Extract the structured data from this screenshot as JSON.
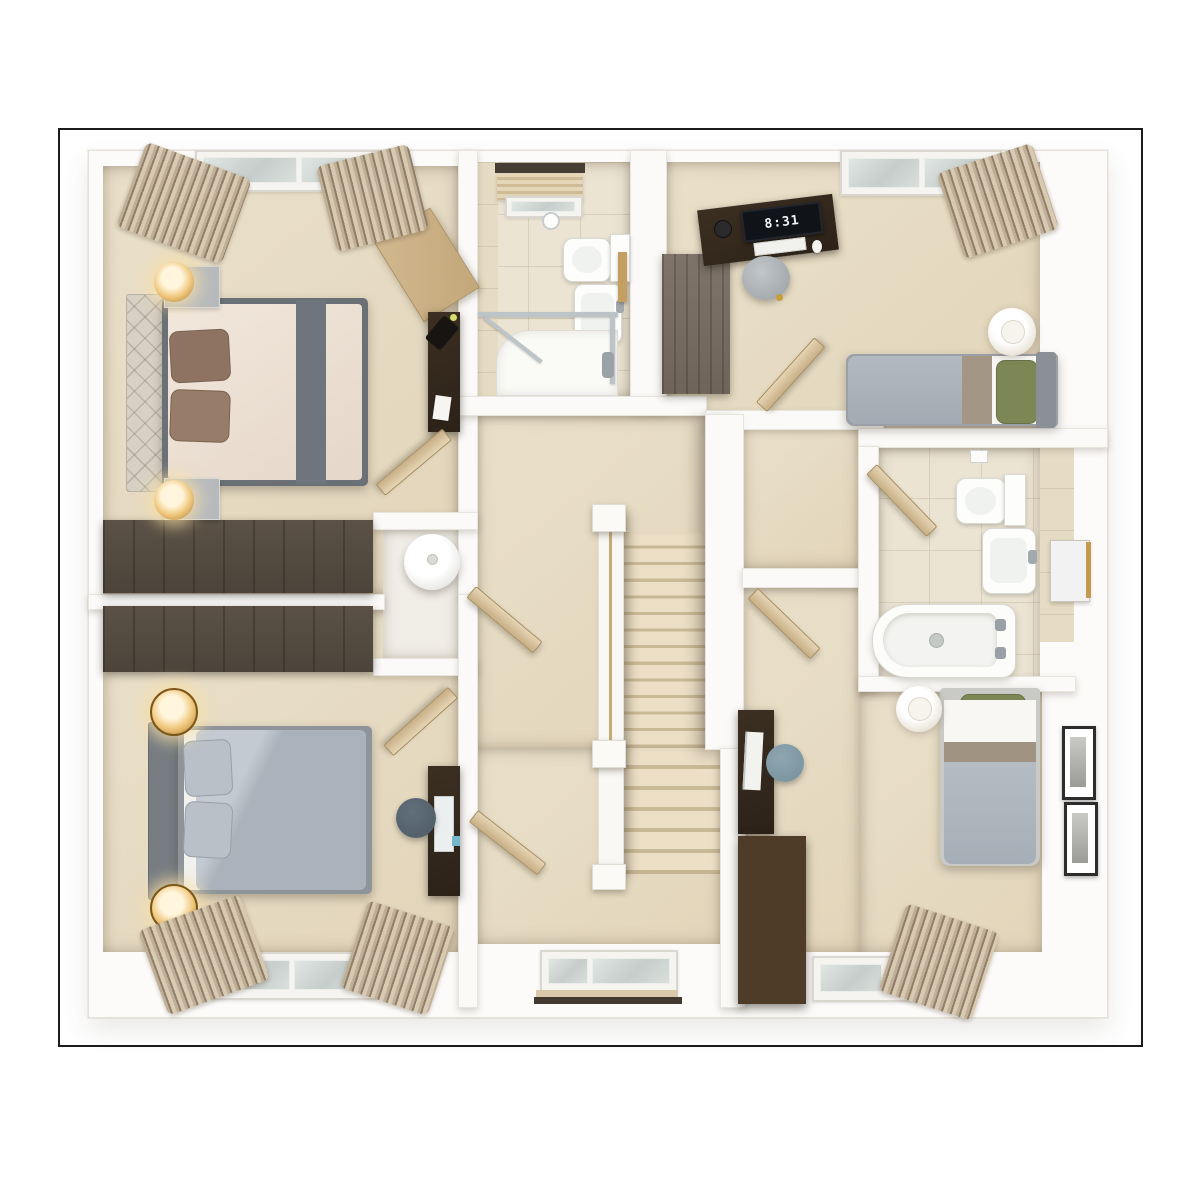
{
  "scene": {
    "type": "3d-top-down-floor-plan-render",
    "rooms": [
      {
        "name": "bedroom-top-left",
        "furniture": [
          "double-bed",
          "tufted-headboard",
          "brown-pillows",
          "grey-bed-runner",
          "two-nightstands",
          "two-amber-table-lamps",
          "corner-desk",
          "dark-side-cabinet",
          "desk-lamp",
          "built-in-wardrobe",
          "window-with-curtains",
          "open-door"
        ]
      },
      {
        "name": "ensuite-shower-room",
        "furniture": [
          "toilet",
          "cistern",
          "wash-basin",
          "shower-tray",
          "glass-shower-screen",
          "roller-blind-window",
          "wood-shelf",
          "towel-ring"
        ]
      },
      {
        "name": "bedroom-top-right",
        "furniture": [
          "single-bed",
          "green-pillow",
          "grey-duvet",
          "desk",
          "monitor-with-clock",
          "keyboard",
          "mouse",
          "alarm-clock",
          "round-pouf",
          "wardrobe",
          "white-table-lamp",
          "window-with-curtain",
          "open-door"
        ]
      },
      {
        "name": "family-bathroom",
        "furniture": [
          "toilet",
          "cistern",
          "wash-basin",
          "mirror-cabinet",
          "bathtub",
          "open-door"
        ]
      },
      {
        "name": "landing",
        "furniture": [
          "staircase-upper-flight",
          "staircase-lower-flight",
          "balustrade",
          "newel-posts",
          "airing-cupboard",
          "hot-water-cylinder",
          "hall-window",
          "open-doors"
        ]
      },
      {
        "name": "bedroom-bottom-left",
        "furniture": [
          "double-bed",
          "grey-duvet",
          "grey-pillows",
          "two-brass-table-lamps",
          "built-in-wardrobe",
          "desk",
          "round-stool",
          "window-with-curtains",
          "open-door"
        ]
      },
      {
        "name": "bedroom-bottom-right",
        "furniture": [
          "single-bed",
          "green-pillow",
          "white-table-lamp",
          "desk",
          "monitor",
          "round-chair",
          "chest-of-drawers",
          "two-framed-pictures",
          "window-with-curtain",
          "open-door"
        ]
      }
    ]
  },
  "monitor_clock": {
    "time": "8:31"
  },
  "palette": {
    "page_background": "#ffffff",
    "frame_border": "#1c1c1e",
    "wall": "#fbfaf8",
    "carpet": "#e7dcc5",
    "bathroom_tile": "#ece4d2",
    "stair_tread": "#eadfc8",
    "dark_wood": "#31281e",
    "wardrobe_wood": "#554b40",
    "light_wood_door": "#d8c5a1",
    "duvet_grey": "#aeb7bf",
    "duvet_cream": "#efe4d9",
    "pillow_brown": "#8e7362",
    "pillow_green": "#7d8655",
    "lamp_brass": "#c89043",
    "curtain_taupe": "#8f7d66",
    "window_glass": "#cdd3d0"
  }
}
